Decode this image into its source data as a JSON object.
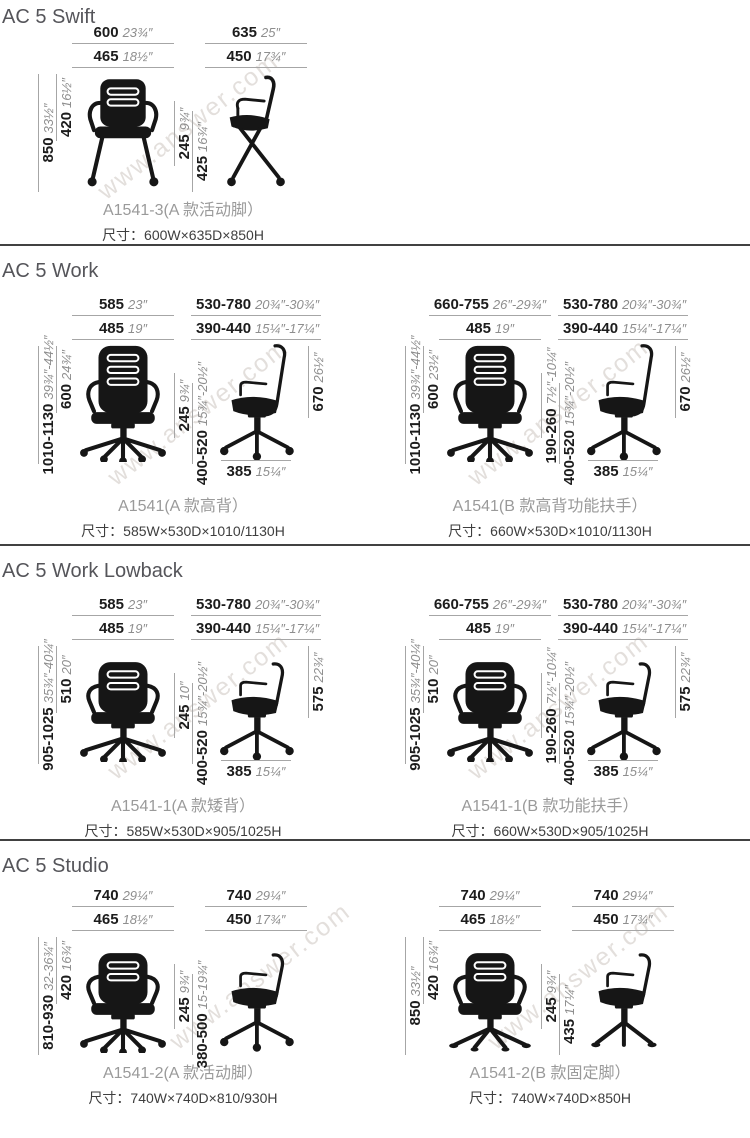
{
  "watermark": {
    "text": "www.answer.com"
  },
  "colors": {
    "mm_text": "#1c1c1c",
    "inch_text": "#8e8e8e",
    "dim_line": "#a6a6a6",
    "divider": "#414141",
    "section_title": "#55555a",
    "caption_model": "#9a9a9a",
    "caption_size": "#3e3e3e",
    "chair_fill": "#161616",
    "watermark": "#cdc6c0"
  },
  "sections": [
    {
      "title": "AC 5 Swift",
      "figures": [
        {
          "front_variant": "swift-front",
          "side_variant": "swift-side",
          "front_top1": {
            "mm": "600",
            "in": "23¾″"
          },
          "front_top2": {
            "mm": "465",
            "in": "18½″"
          },
          "side_top1": {
            "mm": "635",
            "in": "25″"
          },
          "side_top2": {
            "mm": "450",
            "in": "17¾″"
          },
          "left_outer": {
            "mm": "850",
            "in": "33½″"
          },
          "left_inner": {
            "mm": "420",
            "in": "16½″"
          },
          "mid1": {
            "mm": "245",
            "in": "9¾″"
          },
          "mid2": {
            "mm": "425",
            "in": "16¾″"
          },
          "caption_model": "A1541-3(A 款活动脚）",
          "caption_size": "尺寸：600W×635D×850H"
        }
      ]
    },
    {
      "title": "AC 5 Work",
      "figures": [
        {
          "front_variant": "front-high",
          "side_variant": "side-high",
          "front_top1": {
            "mm": "585",
            "in": "23″"
          },
          "front_top2": {
            "mm": "485",
            "in": "19″"
          },
          "side_top1": {
            "mm": "530-780",
            "in": "20¾″-30¾″"
          },
          "side_top2": {
            "mm": "390-440",
            "in": "15¼″-17¼″"
          },
          "left_outer": {
            "mm": "1010-1130",
            "in": "39¾″-44½″"
          },
          "left_inner": {
            "mm": "600",
            "in": "24¾″"
          },
          "mid1": {
            "mm": "245",
            "in": "9¾″"
          },
          "mid2": {
            "mm": "400-520",
            "in": "15¾″-20½″"
          },
          "right": {
            "mm": "670",
            "in": "26½″"
          },
          "bottom": {
            "mm": "385",
            "in": "15¼″"
          },
          "caption_model": "A1541(A 款高背）",
          "caption_size": "尺寸：585W×530D×1010/1130H"
        },
        {
          "front_variant": "front-high",
          "side_variant": "side-high",
          "front_top1": {
            "mm": "660-755",
            "in": "26″-29¾″"
          },
          "front_top2": {
            "mm": "485",
            "in": "19″"
          },
          "side_top1": {
            "mm": "530-780",
            "in": "20¾″-30¾″"
          },
          "side_top2": {
            "mm": "390-440",
            "in": "15¼″-17¼″"
          },
          "left_outer": {
            "mm": "1010-1130",
            "in": "39¾″-44½″"
          },
          "left_inner": {
            "mm": "600",
            "in": "23½″"
          },
          "mid1": {
            "mm": "190-260",
            "in": "7½″-10¼″"
          },
          "mid2": {
            "mm": "400-520",
            "in": "15¾″-20½″"
          },
          "right": {
            "mm": "670",
            "in": "26½″"
          },
          "bottom": {
            "mm": "385",
            "in": "15¼″"
          },
          "caption_model": "A1541(B 款高背功能扶手）",
          "caption_size": "尺寸：660W×530D×1010/1130H"
        }
      ]
    },
    {
      "title": "AC 5 Work Lowback",
      "figures": [
        {
          "front_variant": "front-low",
          "side_variant": "side-low",
          "front_top1": {
            "mm": "585",
            "in": "23″"
          },
          "front_top2": {
            "mm": "485",
            "in": "19″"
          },
          "side_top1": {
            "mm": "530-780",
            "in": "20¾″-30¾″"
          },
          "side_top2": {
            "mm": "390-440",
            "in": "15¼″-17¼″"
          },
          "left_outer": {
            "mm": "905-1025",
            "in": "35¾″-40¼″"
          },
          "left_inner": {
            "mm": "510",
            "in": "20″"
          },
          "mid1": {
            "mm": "245",
            "in": "10″"
          },
          "mid2": {
            "mm": "400-520",
            "in": "15¾″-20½″"
          },
          "right": {
            "mm": "575",
            "in": "22¾″"
          },
          "bottom": {
            "mm": "385",
            "in": "15¼″"
          },
          "caption_model": "A1541-1(A 款矮背）",
          "caption_size": "尺寸：585W×530D×905/1025H"
        },
        {
          "front_variant": "front-low",
          "side_variant": "side-low",
          "front_top1": {
            "mm": "660-755",
            "in": "26″-29¾″"
          },
          "front_top2": {
            "mm": "485",
            "in": "19″"
          },
          "side_top1": {
            "mm": "530-780",
            "in": "20¾″-30¾″"
          },
          "side_top2": {
            "mm": "390-440",
            "in": "15¼″-17¼″"
          },
          "left_outer": {
            "mm": "905-1025",
            "in": "35¾″-40¼″"
          },
          "left_inner": {
            "mm": "510",
            "in": "20″"
          },
          "mid1": {
            "mm": "190-260",
            "in": "7½″-10¼″"
          },
          "mid2": {
            "mm": "400-520",
            "in": "15¾″-20½″"
          },
          "right": {
            "mm": "575",
            "in": "22¾″"
          },
          "bottom": {
            "mm": "385",
            "in": "15¼″"
          },
          "caption_model": "A1541-1(B 款功能扶手）",
          "caption_size": "尺寸：660W×530D×905/1025H"
        }
      ]
    },
    {
      "title": "AC 5 Studio",
      "figures": [
        {
          "front_variant": "front-low",
          "side_variant": "side-low",
          "front_top1": {
            "mm": "740",
            "in": "29¼″"
          },
          "front_top2": {
            "mm": "465",
            "in": "18½″"
          },
          "side_top1": {
            "mm": "740",
            "in": "29¼″"
          },
          "side_top2": {
            "mm": "450",
            "in": "17¾″"
          },
          "left_outer": {
            "mm": "810-930",
            "in": "32-36¾″"
          },
          "left_inner": {
            "mm": "420",
            "in": "16¾″"
          },
          "mid1": {
            "mm": "245",
            "in": "9¾″"
          },
          "mid2": {
            "mm": "380-500",
            "in": "15-19¾″"
          },
          "caption_model": "A1541-2(A 款活动脚）",
          "caption_size": "尺寸：740W×740D×810/930H"
        },
        {
          "front_variant": "front-fixed",
          "side_variant": "side-fixed",
          "front_top1": {
            "mm": "740",
            "in": "29¼″"
          },
          "front_top2": {
            "mm": "465",
            "in": "18½″"
          },
          "side_top1": {
            "mm": "740",
            "in": "29¼″"
          },
          "side_top2": {
            "mm": "450",
            "in": "17¾″"
          },
          "left_outer": {
            "mm": "850",
            "in": "33½″"
          },
          "left_inner": {
            "mm": "420",
            "in": "16¾″"
          },
          "mid1": {
            "mm": "245",
            "in": "9¾″"
          },
          "mid2": {
            "mm": "435",
            "in": "17¼″"
          },
          "caption_model": "A1541-2(B 款固定脚）",
          "caption_size": "尺寸：740W×740D×850H"
        }
      ]
    }
  ]
}
